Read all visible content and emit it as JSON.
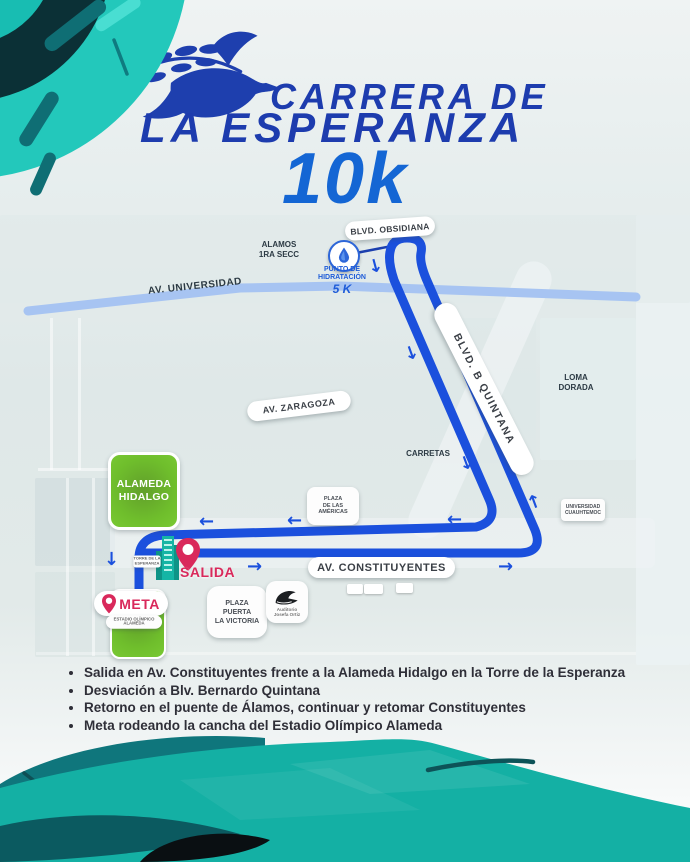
{
  "header": {
    "title_line1": "CARRERA DE",
    "title_line2": "LA ESPERANZA",
    "distance": "10k"
  },
  "map": {
    "road_labels": {
      "obsidiana": "BLVD. OBSIDIANA",
      "universidad": "AV. UNIVERSIDAD",
      "zaragoza": "AV. ZARAGOZA",
      "quintana": "BLVD. B QUINTANA",
      "constituyentes": "AV. CONSTITUYENTES"
    },
    "area_labels": {
      "alamos": "ALAMOS\n1RA SECC",
      "loma_dorada": "LOMA\nDORADA",
      "carretas": "CARRETAS"
    },
    "place_labels": {
      "alameda_hidalgo": "ALAMEDA\nHIDALGO",
      "plaza_americas": "PLAZA\nDE LAS\nAMÉRICAS",
      "universidad_cuauhtemoc": "UNIVERSIDAD\nCUAUHTEMOC",
      "plaza_victoria": "PLAZA\nPUERTA\nLA VICTORIA",
      "auditorio": "Auditorio\nJosefa Ortiz",
      "torre_esperanza": "TORRE DE LA\nESPERANZA",
      "estadio": "ESTADIO OLÍMPICO\nALAMEDA"
    },
    "markers": {
      "salida": "SALIDA",
      "meta": "META",
      "hydration": {
        "line1": "PUNTO DE",
        "line2": "HIDRATACIÓN",
        "distance": "5 K"
      }
    }
  },
  "route_notes": {
    "items": [
      "Salida en Av. Constituyentes frente a la Alameda Hidalgo en la Torre de la Esperanza",
      "Desviación a Blv. Bernardo Quintana",
      "Retorno en el puente de Álamos, continuar y retomar Constituyentes",
      "Meta rodeando la cancha del Estadio Olímpico Alameda"
    ]
  },
  "colors": {
    "route_blue": "#1b50dd",
    "title_blue": "#1d3cae",
    "distance_blue": "#1466d4",
    "teal": "#14b0a4",
    "dark_teal": "#0b3036",
    "pink": "#d9295b",
    "green": "#6fbe2c",
    "road_blue": "#a7c4f2"
  }
}
